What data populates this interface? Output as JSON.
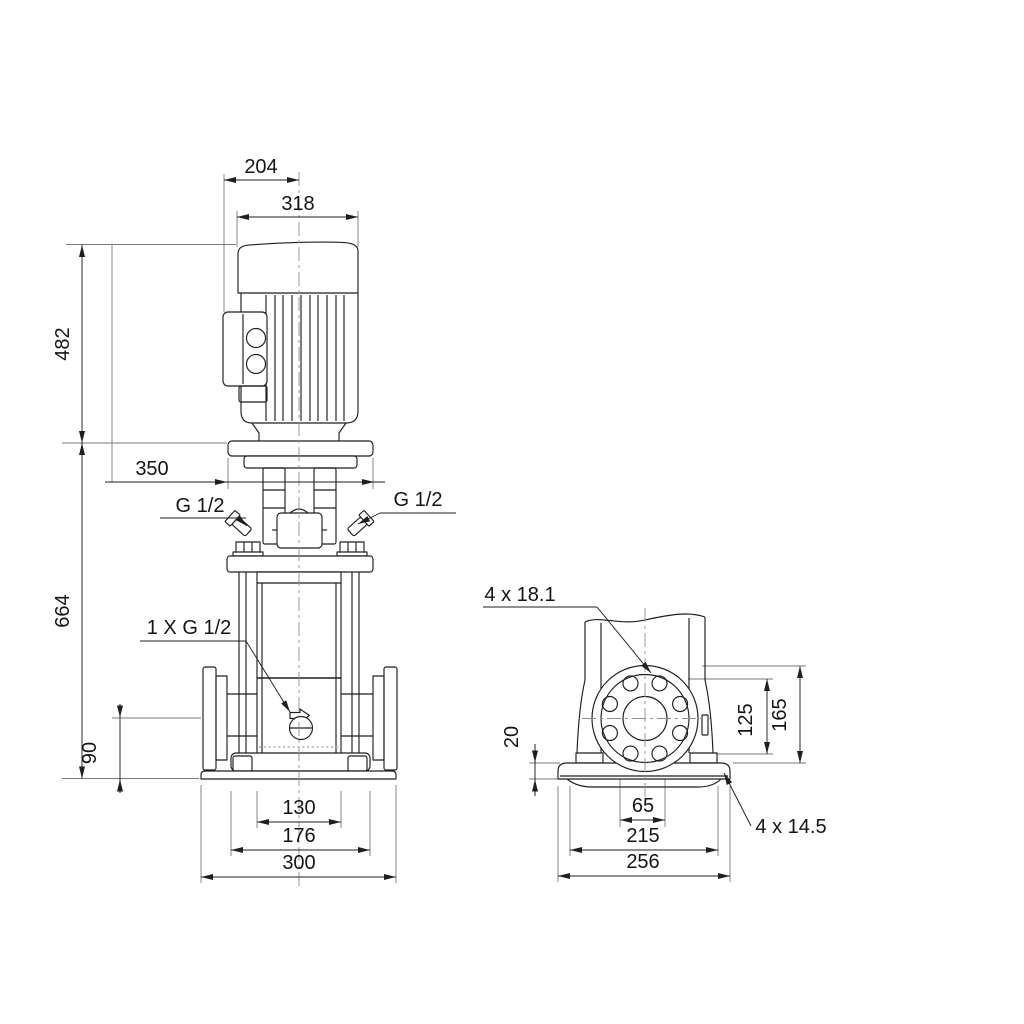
{
  "front_view": {
    "dim_motor_cap_offset": "204",
    "dim_motor_width": "318",
    "dim_motor_height": "482",
    "dim_pump_height": "664",
    "dim_coupling_width": "350",
    "dim_port_height": "90",
    "dim_chamber_width": "130",
    "dim_foot_width": "176",
    "dim_base_width": "300",
    "label_plug_left": "G 1/2",
    "label_plug_right": "G 1/2",
    "label_drain_plug": "1 X G 1/2"
  },
  "side_view": {
    "label_flange_holes": "4 x 18.1",
    "dim_base_thickness": "20",
    "dim_flange_bolt_height": "125",
    "dim_flange_top_height": "165",
    "dim_bolt_spacing": "65",
    "dim_anchor_spacing": "215",
    "dim_base_length": "256",
    "label_anchor_holes": "4 x 14.5"
  },
  "colors": {
    "line": "#1f1f1f",
    "extension": "#7a7a7a",
    "background": "#ffffff"
  }
}
